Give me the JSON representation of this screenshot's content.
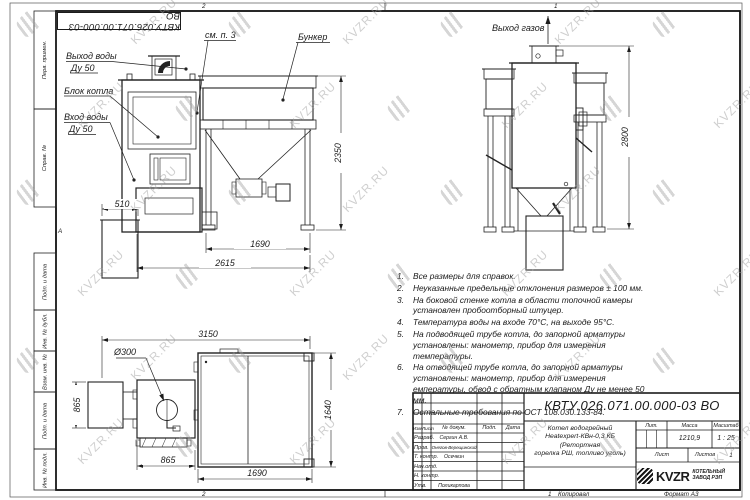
{
  "sheet": {
    "stamp_text": "КВТУ.026.071.00.000-03 ВО",
    "zone_top_left": "2",
    "zone_top_right": "1",
    "zone_bottom_left": "2",
    "zone_bottom_right": "1",
    "zone_marker": "А",
    "margin_fields": [
      "Перв. примен.",
      "Справ. №",
      "Подп. и дата",
      "Инв. № дубл.",
      "Взам. инв. №",
      "Подп. и дата",
      "Инв. № подл."
    ]
  },
  "watermark": {
    "text": "KVZR.RU"
  },
  "front_view": {
    "labels": {
      "water_outlet": "Выход воды",
      "water_outlet_dn": "Ду 50",
      "boiler_block": "Блок котла",
      "water_inlet": "Вход воды",
      "water_inlet_dn": "Ду 50",
      "see_note": "см. п. 3",
      "bunker": "Бункер"
    },
    "dims": {
      "ash_box_width": "510",
      "bunker_height": "2350",
      "bunker_width": "1690",
      "total_depth": "2615"
    }
  },
  "side_view": {
    "labels": {
      "gas_outlet": "Выход газов"
    },
    "dims": {
      "total_height": "2800"
    }
  },
  "plan_view": {
    "dims": {
      "total_width": "3150",
      "left_depth": "865",
      "burner_diameter": "Ø300",
      "front_width": "865",
      "right_width": "1690",
      "right_depth": "1640"
    }
  },
  "notes": {
    "items": [
      "Все размеры для справок.",
      "Неуказанные предельные отклонения размеров ± 100 мм.",
      "На боковой стенке котла в области топочной камеры установлен пробоотборный штуцер.",
      "Температура воды на входе 70°С, на выходе 95°С.",
      "На подводящей трубе котла, до запорной арматуры установлены: манометр, прибор для измерения температуры.",
      "На отводящей трубе котла, до запорной арматуры установлены: манометр, прибор для измерения емпературы, обвод с обратным клапаном Ду не менее 50 мм.",
      "Остальные требования по ОСТ 108.030.133-84."
    ]
  },
  "title_block": {
    "doc_number": "КВТУ.026.071.00.000-03 ВО",
    "product_name": "Котел водогрейный\nHeatexpert-КВн-0,3 КБ (Ретортная\nгорелка РШ, топливо уголь)",
    "header_cols": {
      "izm": "Изм.",
      "list": "Лист",
      "doc": "№ докум.",
      "sign": "Подп.",
      "date": "Дата"
    },
    "rows": [
      {
        "role": "Разраб.",
        "name": "Сергин А.В."
      },
      {
        "role": "Пров.",
        "name": "Онегов-Верещинский"
      },
      {
        "role": "Т. контр.",
        "name": "Осечкин"
      },
      {
        "role": "Нач.отд.",
        "name": ""
      },
      {
        "role": "Н. контр.",
        "name": ""
      },
      {
        "role": "Утв.",
        "name": "Поликарпова"
      }
    ],
    "lit_label": "Лит.",
    "mass_label": "Масса",
    "mass_value": "1210,9",
    "scale_label": "Масштаб",
    "scale_value": "1 : 25",
    "sheet_label": "Лист",
    "sheets_label": "Листов",
    "sheets_value": "1",
    "logo_text": "KVZR",
    "logo_caption": "КОТЕЛЬНЫЙ\nЗАВОД РЭП",
    "copied": "Копировал",
    "format": "Формат А3"
  }
}
